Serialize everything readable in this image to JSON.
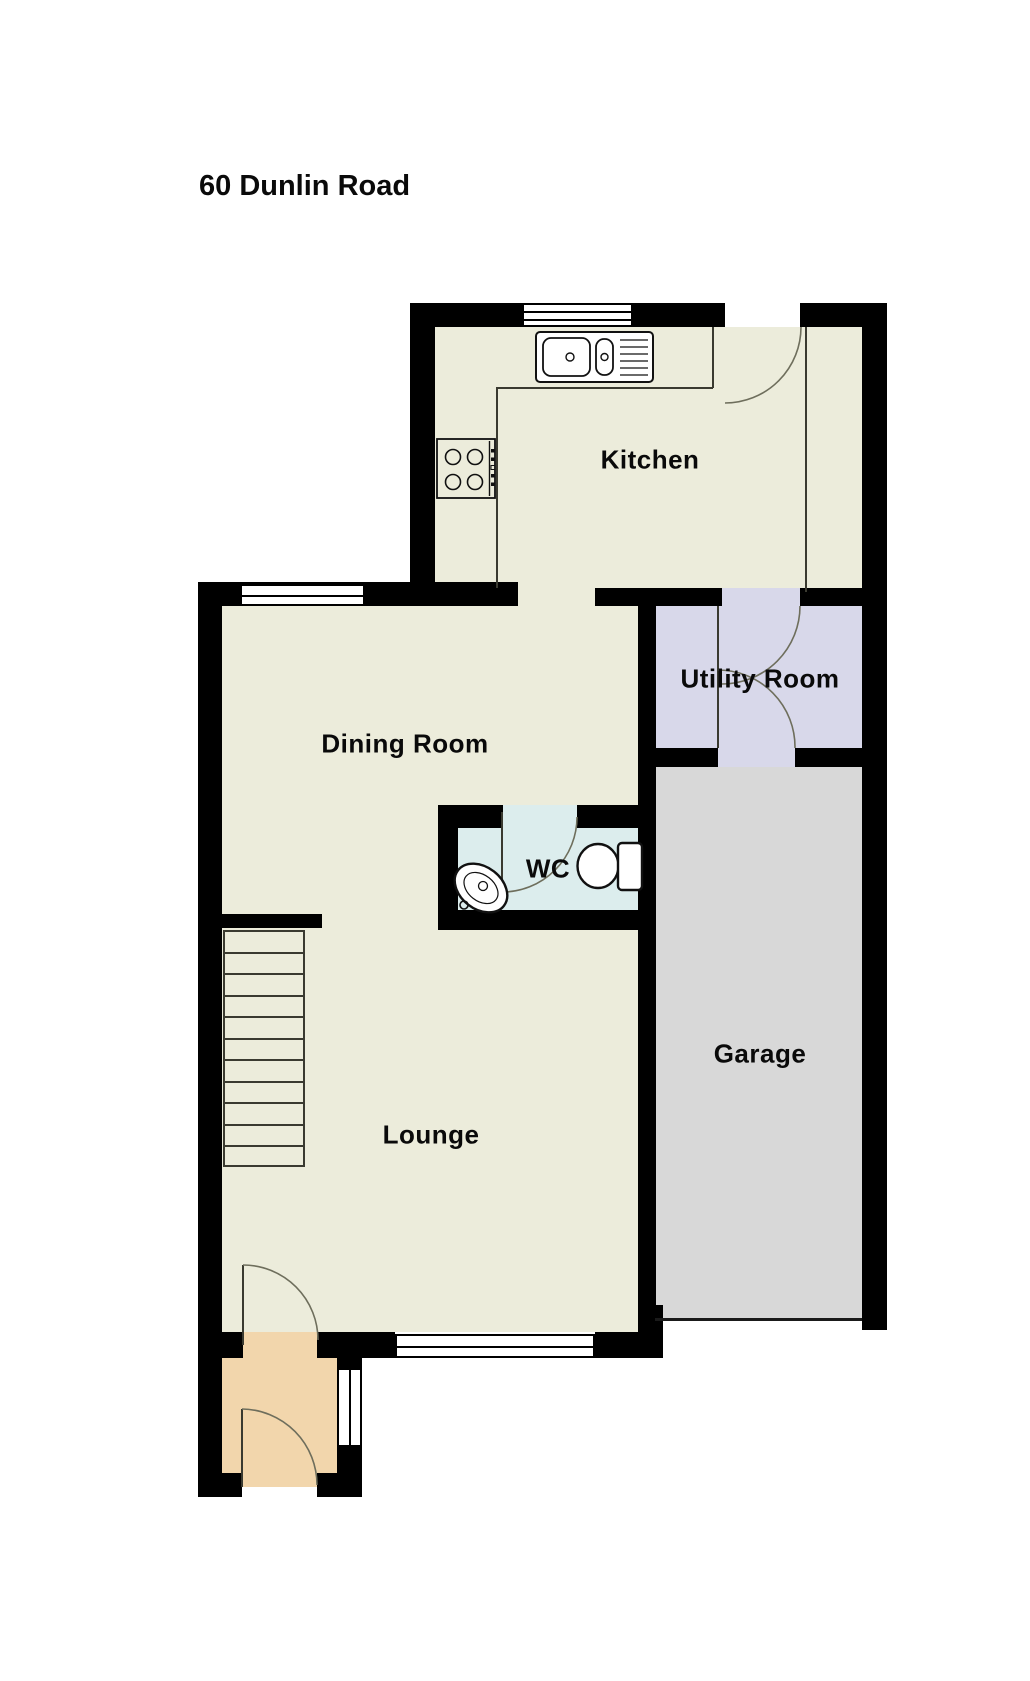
{
  "title": "60 Dunlin Road",
  "rooms": {
    "kitchen": {
      "label": "Kitchen"
    },
    "dining": {
      "label": "Dining Room"
    },
    "utility": {
      "label": "Utility Room"
    },
    "wc": {
      "label": "WC"
    },
    "garage": {
      "label": "Garage"
    },
    "lounge": {
      "label": "Lounge"
    }
  },
  "colors": {
    "wall": "#000000",
    "floor": "#ECECDB",
    "utility_floor": "#D8D8EA",
    "garage_floor": "#D8D8D8",
    "wc_floor": "#DCEDED",
    "porch_floor": "#F2D6AC",
    "outside": "#FFFFFF"
  }
}
